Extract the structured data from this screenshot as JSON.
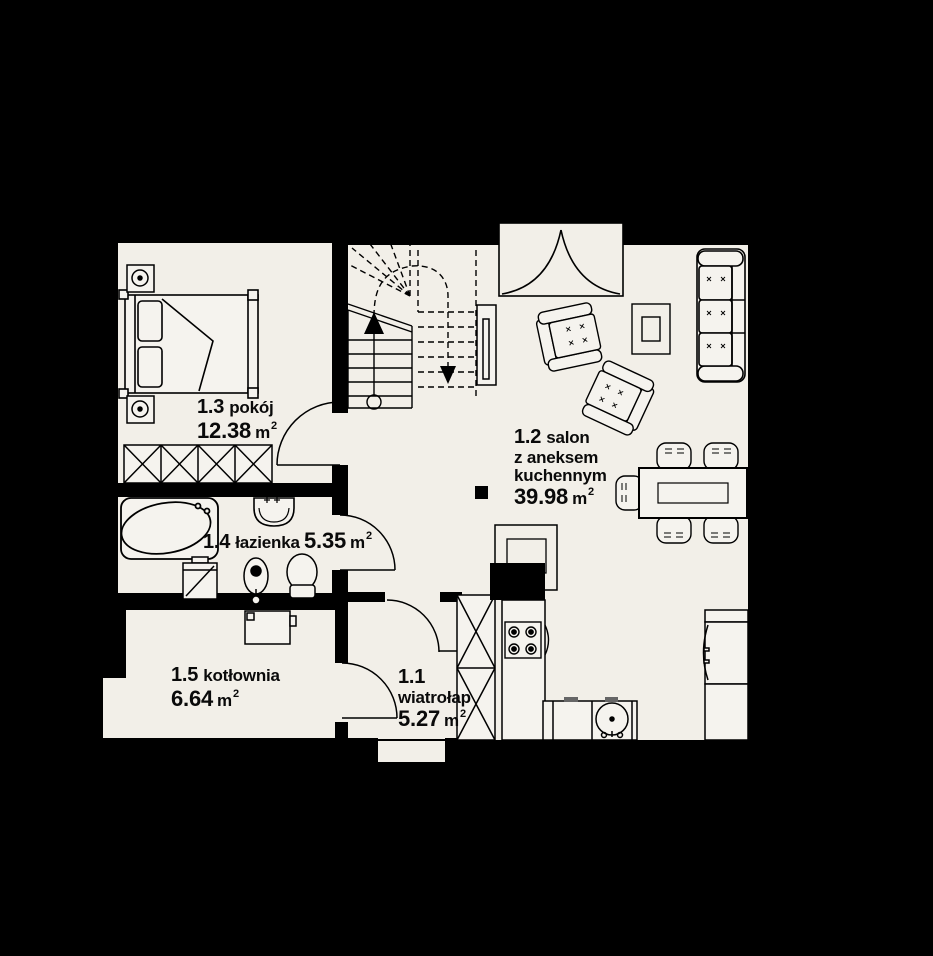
{
  "plan_title": "floor-plan-level-1",
  "rooms": {
    "wiatrolap": {
      "number": "1.1",
      "name": "wiatrołap",
      "area": "5.27",
      "unit": "m",
      "sup": "2"
    },
    "salon": {
      "number": "1.2",
      "name1": "salon",
      "name2": "z aneksem",
      "name3": "kuchennym",
      "area": "39.98",
      "unit": "m",
      "sup": "2"
    },
    "pokoj": {
      "number": "1.3",
      "name": "pokój",
      "area": "12.38",
      "unit": "m",
      "sup": "2"
    },
    "lazienka": {
      "number": "1.4",
      "name": "łazienka",
      "area": "5.35",
      "unit": "m",
      "sup": "2"
    },
    "kotlownia": {
      "number": "1.5",
      "name": "kotłownia",
      "area": "6.64",
      "unit": "m",
      "sup": "2"
    }
  },
  "colors": {
    "background": "#000000",
    "floor": "#f2efe8",
    "line": "#000000",
    "furniture_fill": "#f5f3ee"
  }
}
